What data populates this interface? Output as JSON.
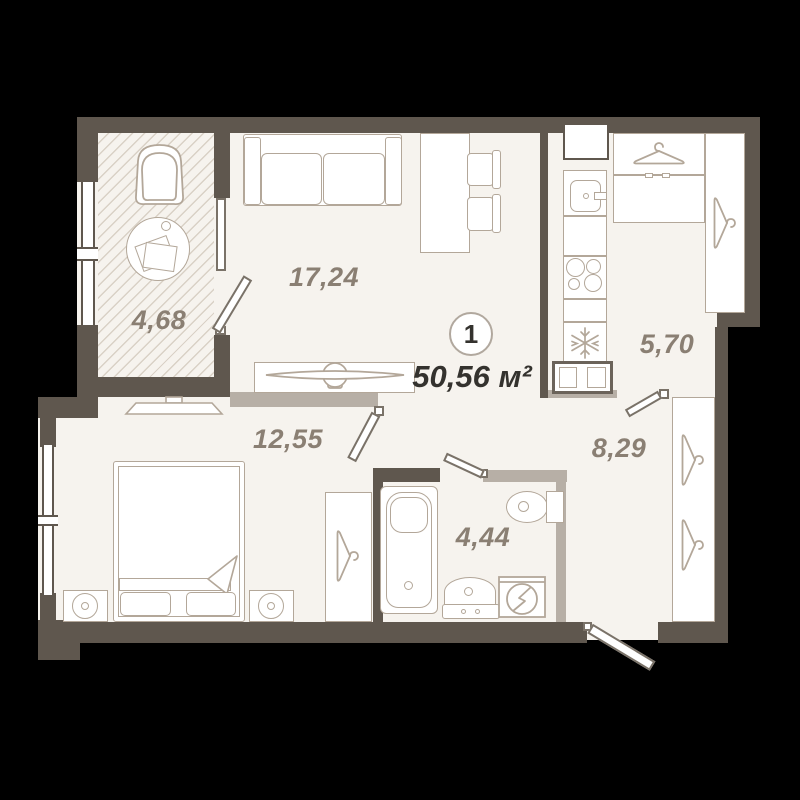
{
  "plan": {
    "badge_number": "1",
    "total_area": "50,56 м²",
    "rooms": [
      {
        "id": "balcony",
        "area": "4,68"
      },
      {
        "id": "living-room",
        "area": "17,24"
      },
      {
        "id": "kitchen",
        "area": "5,70"
      },
      {
        "id": "hallway",
        "area": "8,29"
      },
      {
        "id": "bedroom",
        "area": "12,55"
      },
      {
        "id": "bathroom",
        "area": "4,44"
      }
    ],
    "icons": {
      "wardrobes": "hanger-icon",
      "fridge": "snowflake-icon",
      "washing_machine": "washer-drum-icon"
    },
    "colors": {
      "background": "#000000",
      "floor": "#f6f3ee",
      "exterior_wall": "#5f574e",
      "partition_wall": "#b7afa6",
      "furniture_outline": "#b3a799",
      "room_label": "#8a7f73",
      "dark_text": "#34322e"
    }
  }
}
